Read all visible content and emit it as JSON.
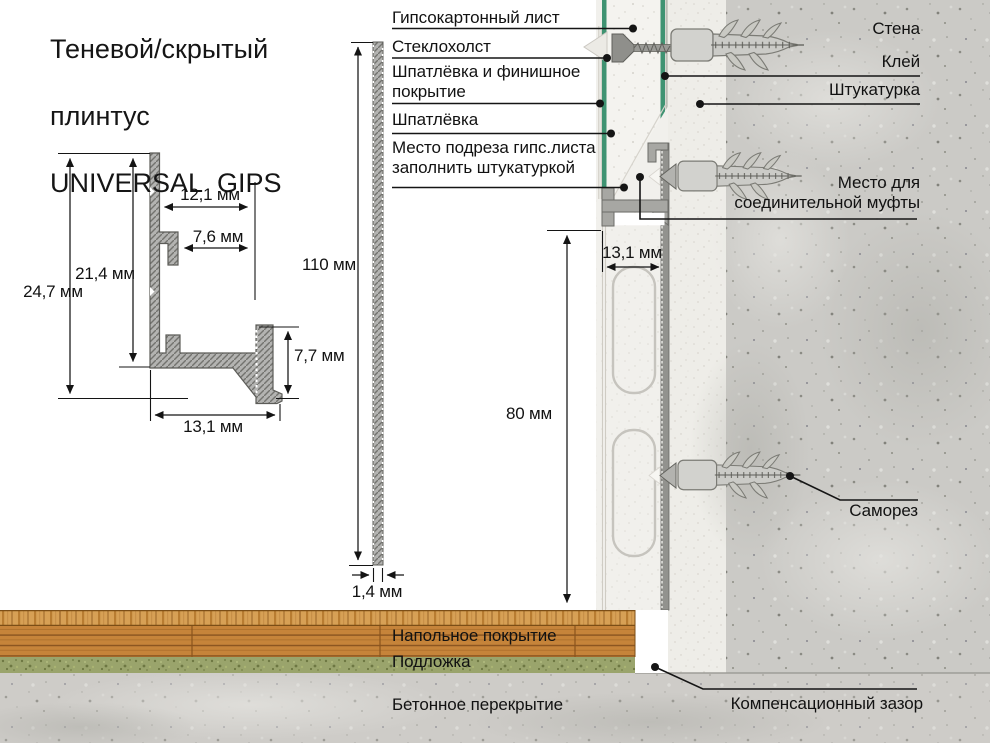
{
  "title": {
    "line1": "Теневой/скрытый",
    "line2": "плинтус",
    "line3": "UNIVERSAL  GIPS"
  },
  "labels": {
    "left": [
      {
        "id": "drywall",
        "text": "Гипсокартонный лист"
      },
      {
        "id": "fiberglass",
        "text": "Стеклохолст"
      },
      {
        "id": "putty_finish",
        "text": "Шпатлёвка и финишное покрытие"
      },
      {
        "id": "putty",
        "text": "Шпатлёвка"
      },
      {
        "id": "cut_area",
        "text": "Место подреза гипс.листа заполнить штукатуркой"
      }
    ],
    "right": [
      {
        "id": "wall",
        "text": "Стена"
      },
      {
        "id": "glue",
        "text": "Клей"
      },
      {
        "id": "plaster",
        "text": "Штукатурка"
      },
      {
        "id": "coupling",
        "text": "Место для соединительной муфты"
      },
      {
        "id": "screw",
        "text": "Саморез"
      },
      {
        "id": "gap",
        "text": "Компенсационный зазор"
      }
    ],
    "floor": [
      {
        "id": "flooring",
        "text": "Напольное покрытие"
      },
      {
        "id": "underlay",
        "text": "Подложка"
      },
      {
        "id": "slab",
        "text": "Бетонное перекрытие"
      }
    ]
  },
  "dimensions": {
    "profile": {
      "height_total": "24,7 мм",
      "height_inner": "21,4 мм",
      "width_top": "12,1 мм",
      "width_hook": "7,6 мм",
      "height_right": "7,7 мм",
      "width_base": "13,1 мм"
    },
    "strip": {
      "height": "110 мм",
      "thickness": "1,4 мм"
    },
    "wall": {
      "base_width": "13,1 мм",
      "gap_height": "80 мм"
    }
  },
  "colors": {
    "accent_green": "#3f9372",
    "line_black": "#141414",
    "wood": "#c6843a",
    "underlay_green": "#9aa46c",
    "concrete": "#cbcac6"
  }
}
